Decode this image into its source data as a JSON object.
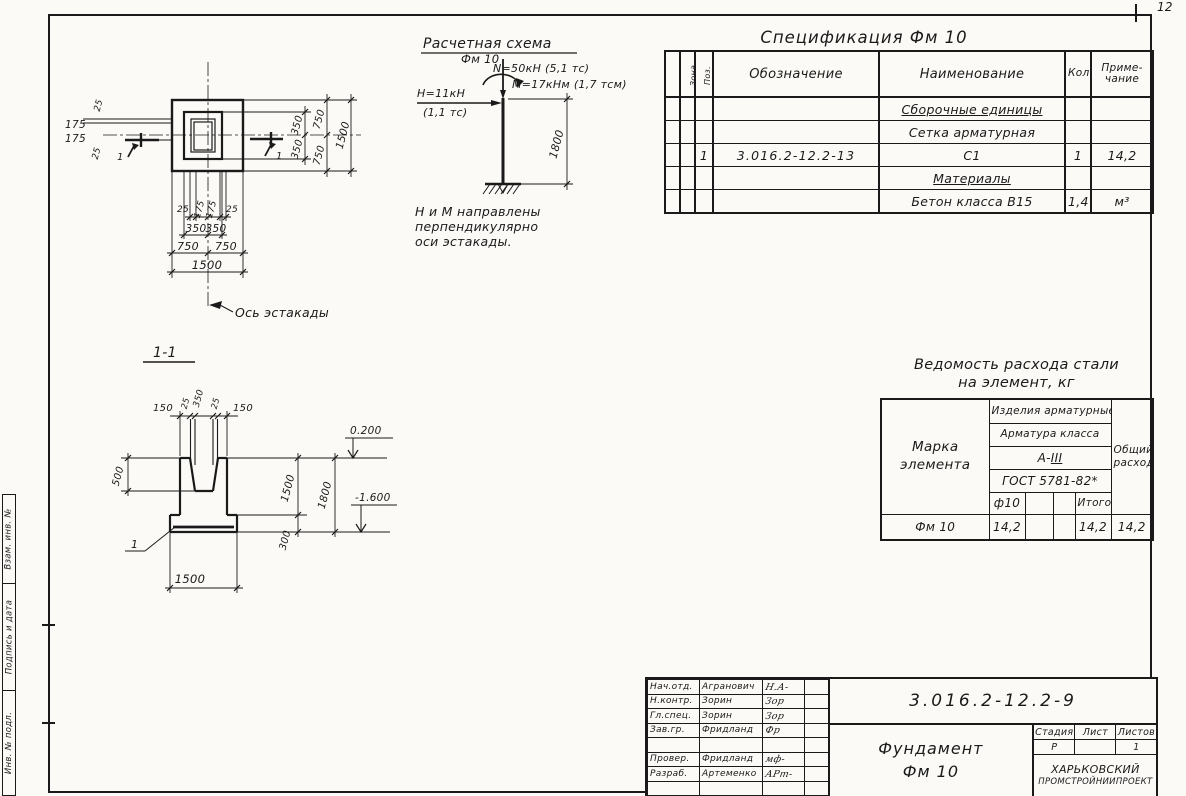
{
  "sheet": {
    "page_number": "12"
  },
  "side_strip": {
    "cells": [
      "Взам. инв. №",
      "Подпись и дата",
      "Инв. № подл."
    ]
  },
  "plan": {
    "dims_left": [
      "25",
      "175",
      "175",
      "25"
    ],
    "dims_right_inner": [
      "350",
      "350"
    ],
    "dims_right_mid": [
      "750",
      "750"
    ],
    "dim_right_total": "1500",
    "dims_bottom_small": [
      "25",
      "175",
      "175",
      "25"
    ],
    "dims_bottom_inner": [
      "350",
      "350"
    ],
    "dims_bottom_mid": [
      "750",
      "750"
    ],
    "dim_bottom_total": "1500",
    "axis_label": "Ось эстакады",
    "cut_mark_left": "1",
    "cut_mark_right": "1"
  },
  "scheme": {
    "title": "Расчетная схема",
    "element": "Фм 10",
    "force_n": "N=50кН (5,1 тс)",
    "moment_m": "M=17кНм (1,7 тсм)",
    "force_h": "H=11кН",
    "force_h_ts": "(1,1 тс)",
    "dim_height": "1800",
    "note_line1": "Н и М направлены",
    "note_line2": "перпендикулярно",
    "note_line3": "оси эстакады."
  },
  "section": {
    "title": "1-1",
    "dims_top": [
      "150",
      "25",
      "350",
      "25",
      "150"
    ],
    "dim_cup_depth": "500",
    "dim_pier": "1500",
    "dim_slab": "300",
    "dim_total": "1800",
    "dim_width": "1500",
    "elev_top": "0.200",
    "elev_bottom": "-1.600",
    "detail_mark": "1"
  },
  "spec": {
    "title": "Спецификация Фм 10",
    "headers": {
      "format": "Формат",
      "zone": "Зона",
      "pos": "Поз.",
      "designation": "Обозначение",
      "name": "Наименование",
      "qty": "Кол.",
      "note_line1": "Приме-",
      "note_line2": "чание"
    },
    "rows": [
      {
        "pos": "",
        "designation": "",
        "name": "Сборочные единицы",
        "qty": "",
        "note": ""
      },
      {
        "pos": "",
        "designation": "",
        "name": "Сетка арматурная",
        "qty": "",
        "note": ""
      },
      {
        "pos": "1",
        "designation": "3.016.2-12.2-13",
        "name": "С1",
        "qty": "1",
        "note": "14,2"
      },
      {
        "pos": "",
        "designation": "",
        "name": "Материалы",
        "qty": "",
        "note": ""
      },
      {
        "pos": "",
        "designation": "",
        "name": "Бетон класса В15",
        "qty": "1,4",
        "note": "м³"
      }
    ]
  },
  "steel": {
    "title_line1": "Ведомость расхода стали",
    "title_line2": "на элемент, кг",
    "header": {
      "mark_line1": "Марка",
      "mark_line2": "элемента",
      "products": "Изделия арматурные",
      "class_label": "Арматура класса",
      "class_prefix": "А-",
      "class_roman": "III",
      "gost": "ГОСТ 5781-82*",
      "dia": "ф10",
      "total": "Итого",
      "overall_line1": "Общий",
      "overall_line2": "расход"
    },
    "row": {
      "mark": "Фм 10",
      "dia_value": "14,2",
      "col2": "",
      "col3": "",
      "total": "14,2",
      "overall": "14,2"
    }
  },
  "stamp": {
    "doc_number": "3.016.2-12.2-9",
    "title_line1": "Фундамент",
    "title_line2": "Фм 10",
    "org_line1": "ХАРЬКОВСКИЙ",
    "org_line2": "ПРОМСТРОЙНИИПРОЕКТ",
    "stage_label": "Стадия",
    "sheet_label": "Лист",
    "sheets_label": "Листов",
    "stage_value": "Р",
    "sheet_value": "",
    "sheets_value": "1",
    "rows": [
      {
        "role": "Нач.отд.",
        "name": "Агранович",
        "sig": "Н.А-"
      },
      {
        "role": "Н.контр.",
        "name": "Зорин",
        "sig": "Зор"
      },
      {
        "role": "Гл.спец.",
        "name": "Зорин",
        "sig": "Зор"
      },
      {
        "role": "Зав.гр.",
        "name": "Фридланд",
        "sig": "Фр"
      },
      {
        "role": "",
        "name": "",
        "sig": ""
      },
      {
        "role": "Провер.",
        "name": "Фридланд",
        "sig": "мф-"
      },
      {
        "role": "Разраб.",
        "name": "Артеменко",
        "sig": "АРт-"
      }
    ]
  }
}
